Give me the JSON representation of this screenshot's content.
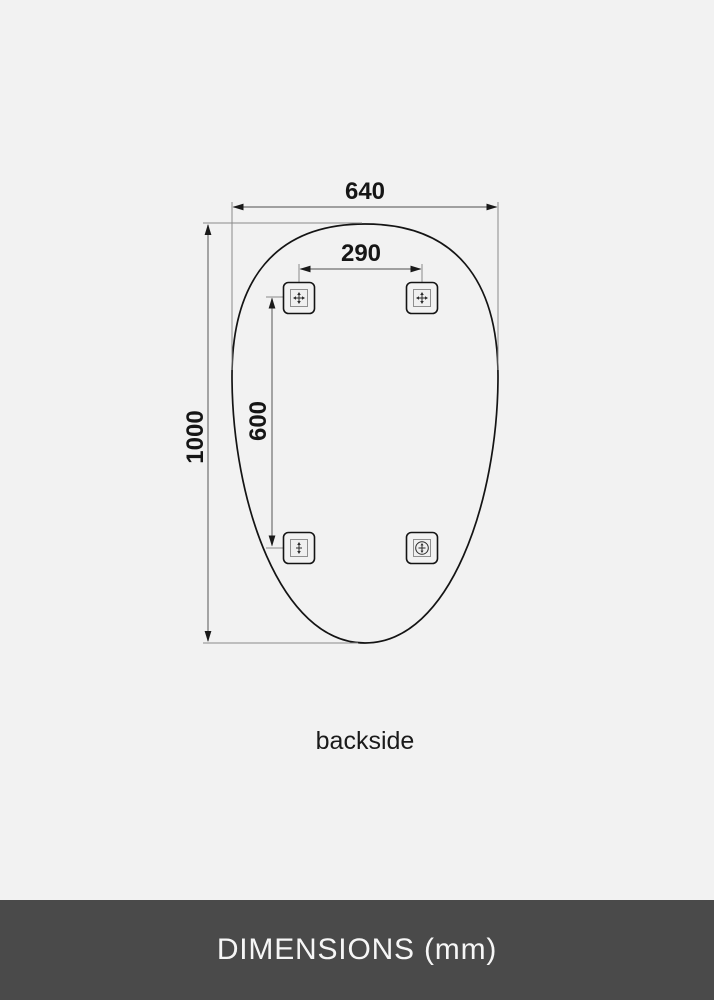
{
  "diagram": {
    "caption": "backside",
    "dimensions": {
      "overall_width_mm": "640",
      "overall_height_mm": "1000",
      "mount_spacing_width_mm": "290",
      "mount_spacing_height_mm": "600"
    }
  },
  "footer": {
    "label": "DIMENSIONS (mm)"
  },
  "colors": {
    "background": "#f2f2f2",
    "line": "#141414",
    "dimension_line": "#707070",
    "footer_background": "#4a4a4a",
    "footer_text": "#f6f6f6"
  }
}
